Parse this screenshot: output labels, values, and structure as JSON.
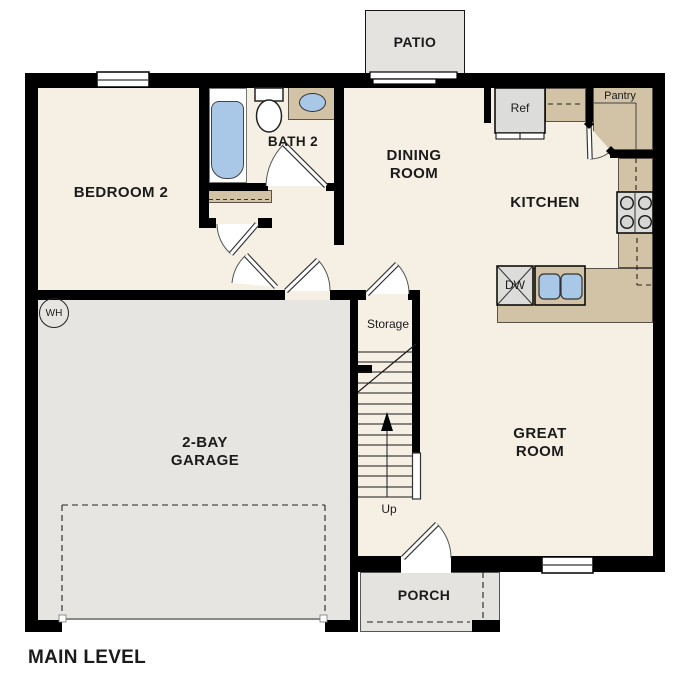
{
  "plan": {
    "level_label": "MAIN LEVEL",
    "rooms": {
      "patio": {
        "label": "PATIO"
      },
      "bedroom2": {
        "label": "BEDROOM 2"
      },
      "bath2": {
        "label": "BATH 2"
      },
      "dining_room": {
        "line1": "DINING",
        "line2": "ROOM"
      },
      "kitchen": {
        "label": "KITCHEN"
      },
      "pantry": {
        "label": "Pantry"
      },
      "great_room": {
        "line1": "GREAT",
        "line2": "ROOM"
      },
      "garage": {
        "line1": "2-BAY",
        "line2": "GARAGE"
      },
      "storage": {
        "label": "Storage"
      },
      "porch": {
        "label": "PORCH"
      }
    },
    "fixtures": {
      "refrigerator": "Ref",
      "dishwasher": "DW",
      "water_heater": "WH",
      "stairs_direction": "Up"
    },
    "colors": {
      "wall": "#000000",
      "floor": "#f6f0e4",
      "exterior_concrete": "#e4e3df",
      "counter": "#d2c3a7",
      "plumbing_blue": "#a9c8e8",
      "appliance": "#dcdcda",
      "text": "#1b1b1b"
    }
  }
}
